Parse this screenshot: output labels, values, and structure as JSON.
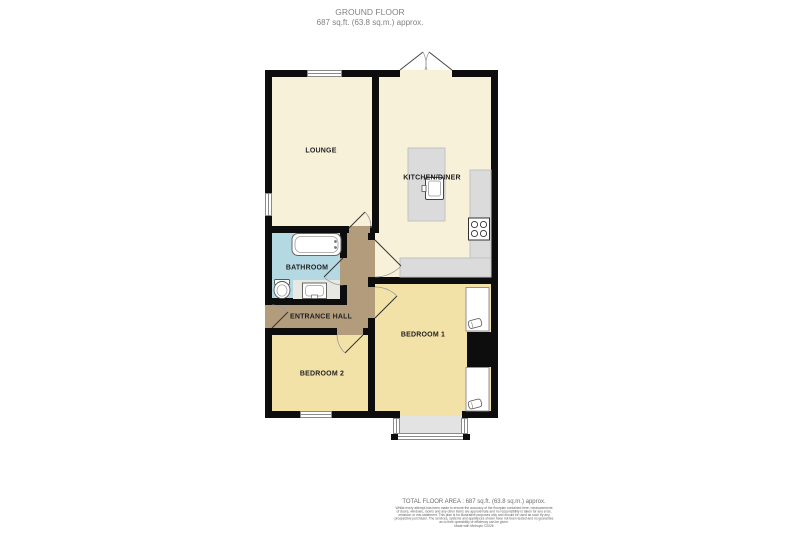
{
  "header": {
    "title": "GROUND FLOOR",
    "subtitle": "687 sq.ft. (63.8 sq.m.) approx."
  },
  "rooms": {
    "lounge": "LOUNGE",
    "kitchen": "KITCHEN/DINER",
    "bathroom": "BATHROOM",
    "hall": "ENTRANCE HALL",
    "bedroom1": "BEDROOM 1",
    "bedroom2": "BEDROOM 2"
  },
  "footer": {
    "total": "TOTAL FLOOR AREA : 687 sq.ft. (63.8 sq.m.) approx.",
    "disclaimer_lines": [
      "Whilst every attempt has been made to ensure the accuracy of the floorplan contained here, measurements",
      "of doors, windows, rooms and any other items are approximate and no responsibility is taken for any error,",
      "omission or mis-statement. This plan is for illustrative purposes only and should be used as such by any",
      "prospective purchaser. The services, systems and appliances shown have not been tested and no guarantee",
      "as to their operability or efficiency can be given.",
      "Made with Metropix ©2026"
    ]
  },
  "colors": {
    "wall": "#0d0d0d",
    "room_cream": "#F7F1DA",
    "room_yellow": "#F2E2A7",
    "room_blue": "#B5D9E2",
    "room_tan": "#B29C7C",
    "counter_gray": "#DBDBDB",
    "bay_gray": "#E3E3E3",
    "label_text": "#1f1f1f",
    "header_text": "#828282",
    "footer_text": "#6e6e6e"
  }
}
